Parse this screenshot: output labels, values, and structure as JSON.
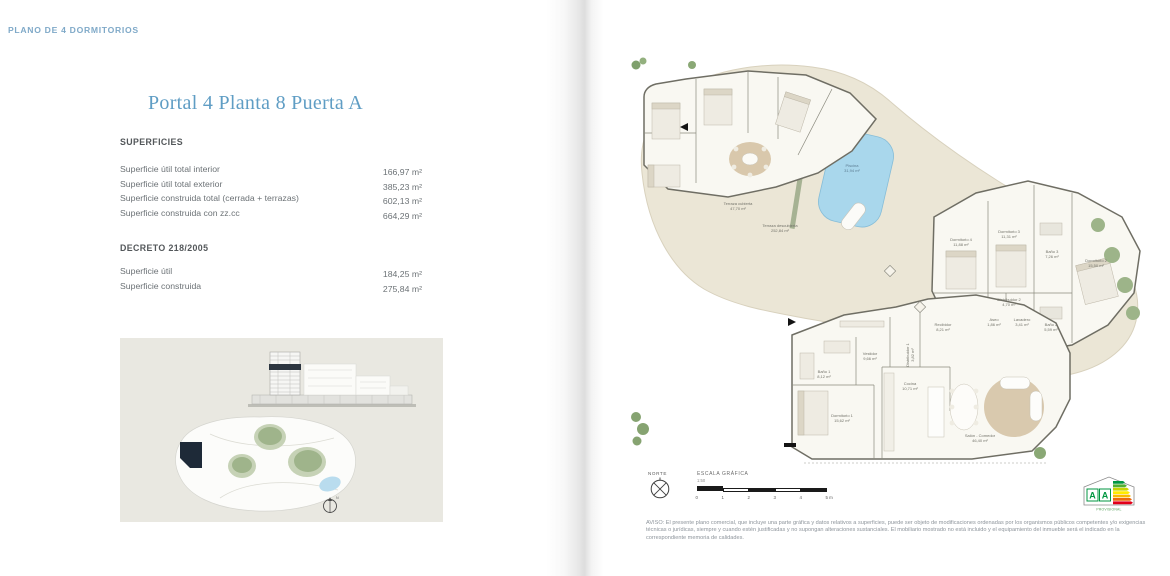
{
  "header": {
    "label": "PLANO DE 4 DORMITORIOS"
  },
  "left_page": {
    "title": "Portal 4 Planta 8 Puerta A",
    "superficies_heading": "SUPERFICIES",
    "superficies_rows": [
      {
        "label": "Superficie útil total interior",
        "value": "166,97 m²"
      },
      {
        "label": "Superficie útil total exterior",
        "value": "385,23 m²"
      },
      {
        "label": "Superficie construida total (cerrada + terrazas)",
        "value": "602,13 m²"
      },
      {
        "label": "Superficie construida con zz.cc",
        "value": "664,29 m²"
      }
    ],
    "decreto_heading": "DECRETO 218/2005",
    "decreto_rows": [
      {
        "label": "Superficie útil",
        "value": "184,25 m²"
      },
      {
        "label": "Superficie construida",
        "value": "275,84 m²"
      }
    ]
  },
  "plan": {
    "rooms": [
      {
        "name": "Piscina",
        "area": "31,94 m²",
        "x": 224,
        "y": 112,
        "pool": true
      },
      {
        "name": "Terraza cubierta",
        "area": "47,70 m²",
        "x": 110,
        "y": 150
      },
      {
        "name": "Terraza descubierta",
        "area": "252,84 m²",
        "x": 152,
        "y": 172
      },
      {
        "name": "Dormitorio 4",
        "area": "11,88 m²",
        "x": 333,
        "y": 186
      },
      {
        "name": "Dormitorio 3",
        "area": "11,31 m²",
        "x": 381,
        "y": 178
      },
      {
        "name": "Baño 3",
        "area": "7,26 m²",
        "x": 424,
        "y": 198
      },
      {
        "name": "Dormitorio 2",
        "area": "15,50 m²",
        "x": 468,
        "y": 207
      },
      {
        "name": "Distribuidor 2",
        "area": "4,70 m²",
        "x": 381,
        "y": 246
      },
      {
        "name": "Aseo",
        "area": "1,86 m²",
        "x": 366,
        "y": 266
      },
      {
        "name": "Lavadero",
        "area": "3,41 m²",
        "x": 394,
        "y": 266
      },
      {
        "name": "Baño 2",
        "area": "5,59 m²",
        "x": 423,
        "y": 271
      },
      {
        "name": "Recibidor",
        "area": "8,21 m²",
        "x": 315,
        "y": 271
      },
      {
        "name": "Vestidor",
        "area": "9,66 m²",
        "x": 242,
        "y": 300
      },
      {
        "name": "Distribuidor 1",
        "area": "3,82 m²",
        "x": 281,
        "y": 300,
        "vertical": true
      },
      {
        "name": "Baño 1",
        "area": "8,12 m²",
        "x": 196,
        "y": 318
      },
      {
        "name": "Cocina",
        "area": "10,71 m²",
        "x": 282,
        "y": 330
      },
      {
        "name": "Dormitorio 1",
        "area": "15,62 m²",
        "x": 214,
        "y": 362
      },
      {
        "name": "Salón - Comedor",
        "area": "46,40 m²",
        "x": 352,
        "y": 382
      }
    ]
  },
  "footer": {
    "norte": "NORTE",
    "escala_label": "ESCALA GRÁFICA",
    "escala_ratio": "1:50",
    "scale_ticks": [
      "0",
      "1",
      "2",
      "3",
      "4",
      "5 m"
    ],
    "energy_letters": [
      "A",
      "A"
    ],
    "energy_status": "PROVISIONAL",
    "aviso": "AVISO: El presente plano comercial, que incluye una parte gráfica y datos relativos a superficies, puede ser objeto de modificaciones ordenadas por los organismos públicos competentes y/o exigencias técnicas o jurídicas, siempre y cuando estén justificadas y no supongan alteraciones sustanciales. El mobiliario mostrado no está incluido y el equipamiento del inmueble será el indicado en la correspondiente memoria de calidades."
  },
  "colors": {
    "accent_blue": "#5f9dc4",
    "header_blue": "#7fa9c8",
    "terrace_beige": "#ebe6d6",
    "pool_blue": "#a9d7ec",
    "highlight_dark": "#1e2a38",
    "text_gray": "#6c7276"
  }
}
